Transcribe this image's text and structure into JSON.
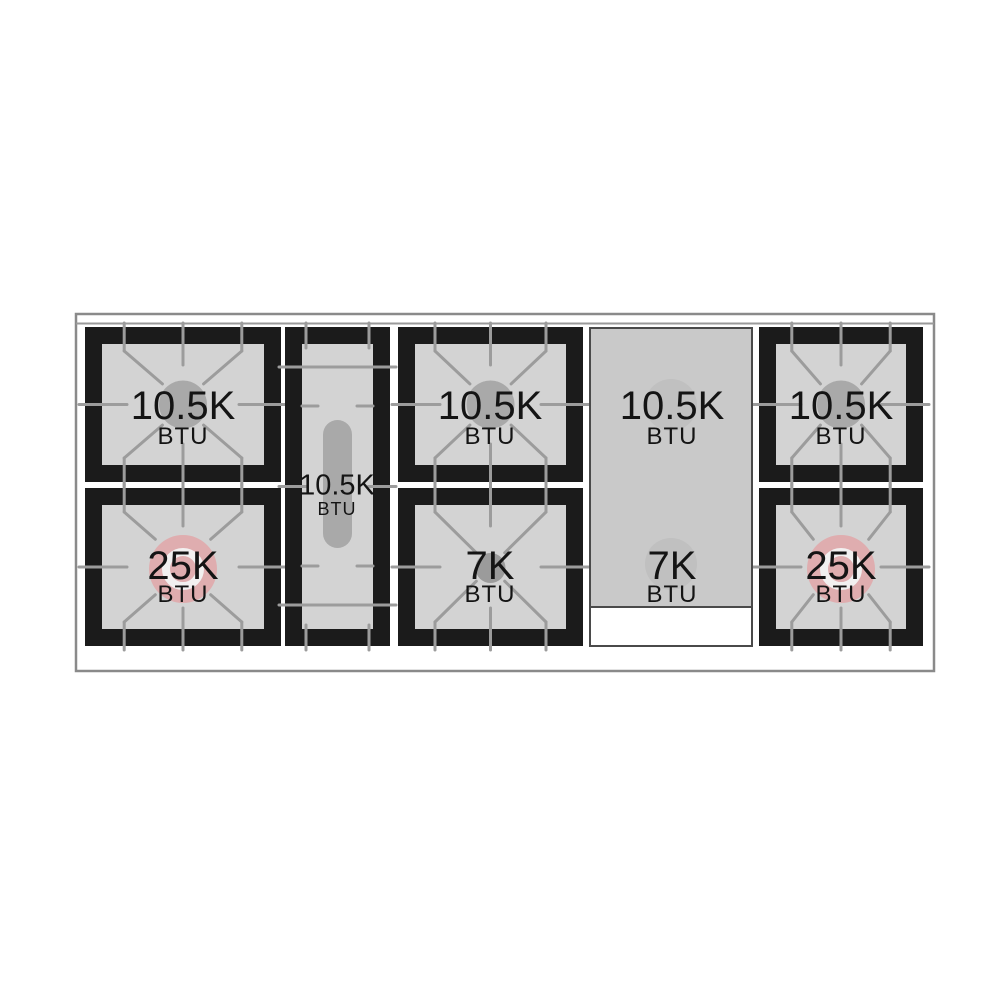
{
  "burners": [
    {
      "id": "left-rear",
      "power": "10.5K",
      "unit": "BTU",
      "cap": "gray"
    },
    {
      "id": "left-front",
      "power": "25K",
      "unit": "BTU",
      "cap": "pink"
    },
    {
      "id": "center-oval",
      "power": "10.5K",
      "unit": "BTU",
      "cap": "oval"
    },
    {
      "id": "middle-rear",
      "power": "10.5K",
      "unit": "BTU",
      "cap": "gray"
    },
    {
      "id": "middle-front",
      "power": "7K",
      "unit": "BTU",
      "cap": "small"
    },
    {
      "id": "griddle-rear",
      "power": "10.5K",
      "unit": "BTU",
      "cap": "griddle"
    },
    {
      "id": "griddle-front",
      "power": "7K",
      "unit": "BTU",
      "cap": "griddle"
    },
    {
      "id": "right-rear",
      "power": "10.5K",
      "unit": "BTU",
      "cap": "gray"
    },
    {
      "id": "right-front",
      "power": "25K",
      "unit": "BTU",
      "cap": "pink"
    }
  ],
  "colors": {
    "frame": "#1b1b1b",
    "surface": "#d3d3d3",
    "griddle_surface": "#c9c9c9",
    "griddle_border": "#4a4a4a",
    "grate_line": "#9c9c9c",
    "burner_standard": "#a9a9a9",
    "burner_small": "#9b9b9b",
    "burner_power": "#dfadaf",
    "burner_power_ring": "#f2f0f0",
    "griddle_burner": "#c0c0c0",
    "outline": "#8a8a8a",
    "text": "#141414",
    "white": "#ffffff"
  }
}
